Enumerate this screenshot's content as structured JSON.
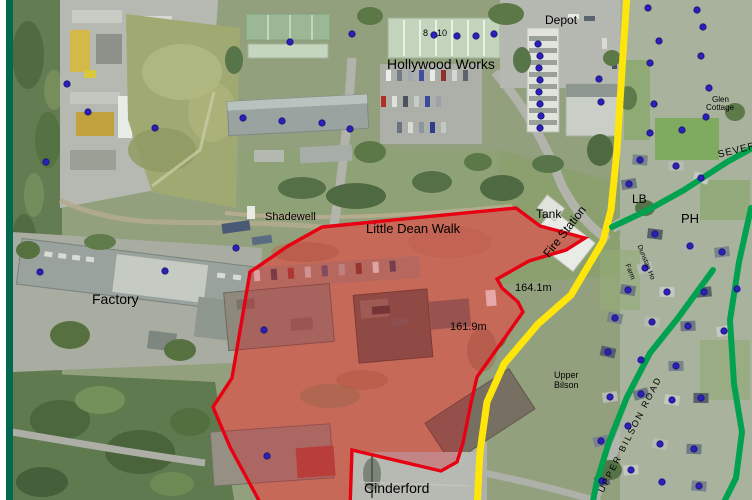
{
  "map_type": "aerial-planning-map",
  "colors": {
    "frame_border": "#00684f",
    "site_boundary": "#e60012",
    "site_fill_opacity": 0.28,
    "site_ground": "#bb9274",
    "road_primary_yellow": "#ffe60a",
    "road_secondary_green": "#00a14f",
    "address_point_blue": "#2b21b8"
  },
  "overlays": {
    "site_boundary": {
      "color": "#e60012",
      "fill_opacity": 0.28,
      "points": [
        [
          322,
          227
        ],
        [
          516,
          208
        ],
        [
          540,
          226
        ],
        [
          585,
          238
        ],
        [
          566,
          250
        ],
        [
          529,
          261
        ],
        [
          497,
          279
        ],
        [
          502,
          288
        ],
        [
          518,
          302
        ],
        [
          523,
          312
        ],
        [
          477,
          377
        ],
        [
          471,
          403
        ],
        [
          463,
          443
        ],
        [
          457,
          462
        ],
        [
          441,
          471
        ],
        [
          352,
          450
        ],
        [
          350,
          508
        ],
        [
          263,
          508
        ],
        [
          230,
          447
        ],
        [
          213,
          407
        ],
        [
          232,
          378
        ],
        [
          250,
          272
        ],
        [
          288,
          246
        ]
      ]
    },
    "roads": [
      {
        "name": "road-overlay-yellow-main",
        "color": "#ffe60a",
        "width": 7,
        "points": [
          [
            627,
            -6
          ],
          [
            622,
            70
          ],
          [
            617,
            150
          ],
          [
            611,
            210
          ],
          [
            603,
            241
          ],
          [
            571,
            295
          ],
          [
            538,
            324
          ],
          [
            504,
            364
          ],
          [
            487,
            402
          ],
          [
            480,
            452
          ],
          [
            477,
            508
          ]
        ]
      },
      {
        "name": "road-overlay-green-severn",
        "color": "#00a14f",
        "width": 6,
        "points": [
          [
            612,
            227
          ],
          [
            648,
            210
          ],
          [
            684,
            190
          ],
          [
            727,
            162
          ],
          [
            756,
            146
          ]
        ]
      },
      {
        "name": "road-overlay-green-east",
        "color": "#00a14f",
        "width": 6,
        "points": [
          [
            751,
            208
          ],
          [
            739,
            262
          ],
          [
            730,
            320
          ],
          [
            734,
            384
          ],
          [
            742,
            432
          ],
          [
            736,
            478
          ],
          [
            722,
            506
          ]
        ]
      },
      {
        "name": "road-overlay-green-upper-bilson",
        "color": "#00a14f",
        "width": 6,
        "points": [
          [
            713,
            270
          ],
          [
            678,
            318
          ],
          [
            650,
            353
          ],
          [
            627,
            397
          ],
          [
            609,
            442
          ],
          [
            597,
            481
          ],
          [
            592,
            506
          ]
        ]
      }
    ],
    "address_points": {
      "color": "#2b21b8",
      "radius": 3.2,
      "points": [
        [
          67,
          84
        ],
        [
          88,
          112
        ],
        [
          46,
          162
        ],
        [
          155,
          128
        ],
        [
          243,
          118
        ],
        [
          282,
          121
        ],
        [
          322,
          123
        ],
        [
          350,
          129
        ],
        [
          290,
          42
        ],
        [
          352,
          34
        ],
        [
          434,
          35
        ],
        [
          457,
          36
        ],
        [
          476,
          36
        ],
        [
          494,
          34
        ],
        [
          538,
          44
        ],
        [
          540,
          56
        ],
        [
          539,
          68
        ],
        [
          540,
          80
        ],
        [
          539,
          92
        ],
        [
          540,
          104
        ],
        [
          541,
          116
        ],
        [
          540,
          128
        ],
        [
          599,
          79
        ],
        [
          601,
          102
        ],
        [
          236,
          248
        ],
        [
          40,
          272
        ],
        [
          165,
          271
        ],
        [
          264,
          330
        ],
        [
          267,
          456
        ],
        [
          648,
          8
        ],
        [
          697,
          10
        ],
        [
          703,
          27
        ],
        [
          659,
          41
        ],
        [
          650,
          63
        ],
        [
          701,
          56
        ],
        [
          709,
          88
        ],
        [
          654,
          104
        ],
        [
          706,
          117
        ],
        [
          682,
          130
        ],
        [
          650,
          133
        ],
        [
          640,
          160
        ],
        [
          676,
          166
        ],
        [
          629,
          184
        ],
        [
          701,
          178
        ],
        [
          655,
          234
        ],
        [
          690,
          246
        ],
        [
          722,
          252
        ],
        [
          645,
          268
        ],
        [
          628,
          290
        ],
        [
          667,
          292
        ],
        [
          704,
          292
        ],
        [
          737,
          289
        ],
        [
          615,
          318
        ],
        [
          652,
          322
        ],
        [
          688,
          326
        ],
        [
          724,
          331
        ],
        [
          608,
          352
        ],
        [
          641,
          360
        ],
        [
          676,
          366
        ],
        [
          610,
          397
        ],
        [
          641,
          394
        ],
        [
          672,
          400
        ],
        [
          701,
          398
        ],
        [
          628,
          426
        ],
        [
          601,
          441
        ],
        [
          660,
          444
        ],
        [
          694,
          449
        ],
        [
          631,
          470
        ],
        [
          602,
          481
        ],
        [
          662,
          482
        ],
        [
          699,
          486
        ]
      ]
    }
  },
  "labels": [
    {
      "id": "depot",
      "text": "Depot",
      "x": 545,
      "y": 14,
      "size": 12
    },
    {
      "id": "hollywood-works",
      "text": "Hollywood Works",
      "x": 387,
      "y": 57,
      "size": 14
    },
    {
      "id": "unit-8",
      "text": "8",
      "x": 423,
      "y": 29,
      "size": 9
    },
    {
      "id": "unit-10",
      "text": "10",
      "x": 437,
      "y": 29,
      "size": 9
    },
    {
      "id": "shadewell",
      "text": "Shadewell",
      "x": 265,
      "y": 212,
      "size": 11
    },
    {
      "id": "little-dean-walk",
      "text": "Little Dean Walk",
      "x": 366,
      "y": 222,
      "size": 13
    },
    {
      "id": "tank",
      "text": "Tank",
      "x": 536,
      "y": 208,
      "size": 12
    },
    {
      "id": "fire-station",
      "text": "Fire Station",
      "x": 541,
      "y": 252,
      "size": 12,
      "rotate": -52
    },
    {
      "id": "spot-height-164",
      "text": "164.1m",
      "x": 515,
      "y": 283,
      "size": 11
    },
    {
      "id": "spot-height-161",
      "text": "161.9m",
      "x": 450,
      "y": 322,
      "size": 11
    },
    {
      "id": "factory",
      "text": "Factory",
      "x": 92,
      "y": 292,
      "size": 14
    },
    {
      "id": "cinderford",
      "text": "Cinderford",
      "x": 364,
      "y": 481,
      "size": 14
    },
    {
      "id": "lb",
      "text": "LB",
      "x": 632,
      "y": 193,
      "size": 12
    },
    {
      "id": "ph",
      "text": "PH",
      "x": 681,
      "y": 212,
      "size": 13
    },
    {
      "id": "severn-street",
      "text": "SEVER",
      "x": 717,
      "y": 151,
      "size": 10,
      "rotate": -14,
      "spacing": 1
    },
    {
      "id": "cottage-line-1",
      "text": "Glen",
      "x": 712,
      "y": 96,
      "size": 8
    },
    {
      "id": "cottage-line-2",
      "text": "Cottage",
      "x": 706,
      "y": 104,
      "size": 8
    },
    {
      "id": "dunstan",
      "text": "Dunstan Ho",
      "x": 642,
      "y": 244,
      "size": 7,
      "rotate": 68
    },
    {
      "id": "farm-lane",
      "text": "Farm",
      "x": 630,
      "y": 263,
      "size": 7,
      "rotate": 68
    },
    {
      "id": "upper-bilson-1",
      "text": "Upper",
      "x": 554,
      "y": 371,
      "size": 9
    },
    {
      "id": "upper-bilson-2",
      "text": "Bilson",
      "x": 554,
      "y": 381,
      "size": 9
    },
    {
      "id": "upper-bilson-road",
      "text": "UPPER BILSON ROAD",
      "x": 597,
      "y": 490,
      "size": 9,
      "rotate": -63,
      "spacing": 2
    }
  ]
}
